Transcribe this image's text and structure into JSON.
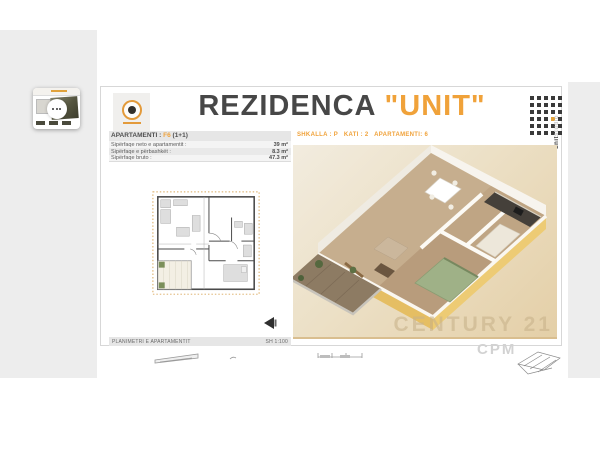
{
  "header": {
    "title_main": "REZIDENCA",
    "title_quoted": "\"UNIT\"",
    "side_text_primary": "unit",
    "side_text_secondary": "studio"
  },
  "info_panel": {
    "heading_label": "APARTAMENTI :",
    "heading_code": "F6",
    "heading_suffix": "(1+1)",
    "rows": [
      {
        "label": "Sipërfaqe neto e apartamentit :",
        "value": "39 m²"
      },
      {
        "label": "Sipërfaqe e përbashkët :",
        "value": "8.3 m²"
      },
      {
        "label": "Sipërfaqe bruto :",
        "value": "47.3 m²"
      }
    ],
    "footer_left": "PLANIMETRI E APARTAMENTIT",
    "footer_right": "SH 1:100"
  },
  "render_panel": {
    "location_line": "SHKALLA : P   KATI : 2   APARTAMENTI: 6",
    "watermark_line1": "CENTURY 21",
    "watermark_line2": "CPM"
  },
  "colors": {
    "accent_orange": "#F0A23A",
    "title_gray": "#474747",
    "viewer_gray": "#EDEDED",
    "beige_light": "#F2ECDF",
    "beige_dark": "#E4CFA7",
    "gold_wall": "#E5BE63"
  }
}
